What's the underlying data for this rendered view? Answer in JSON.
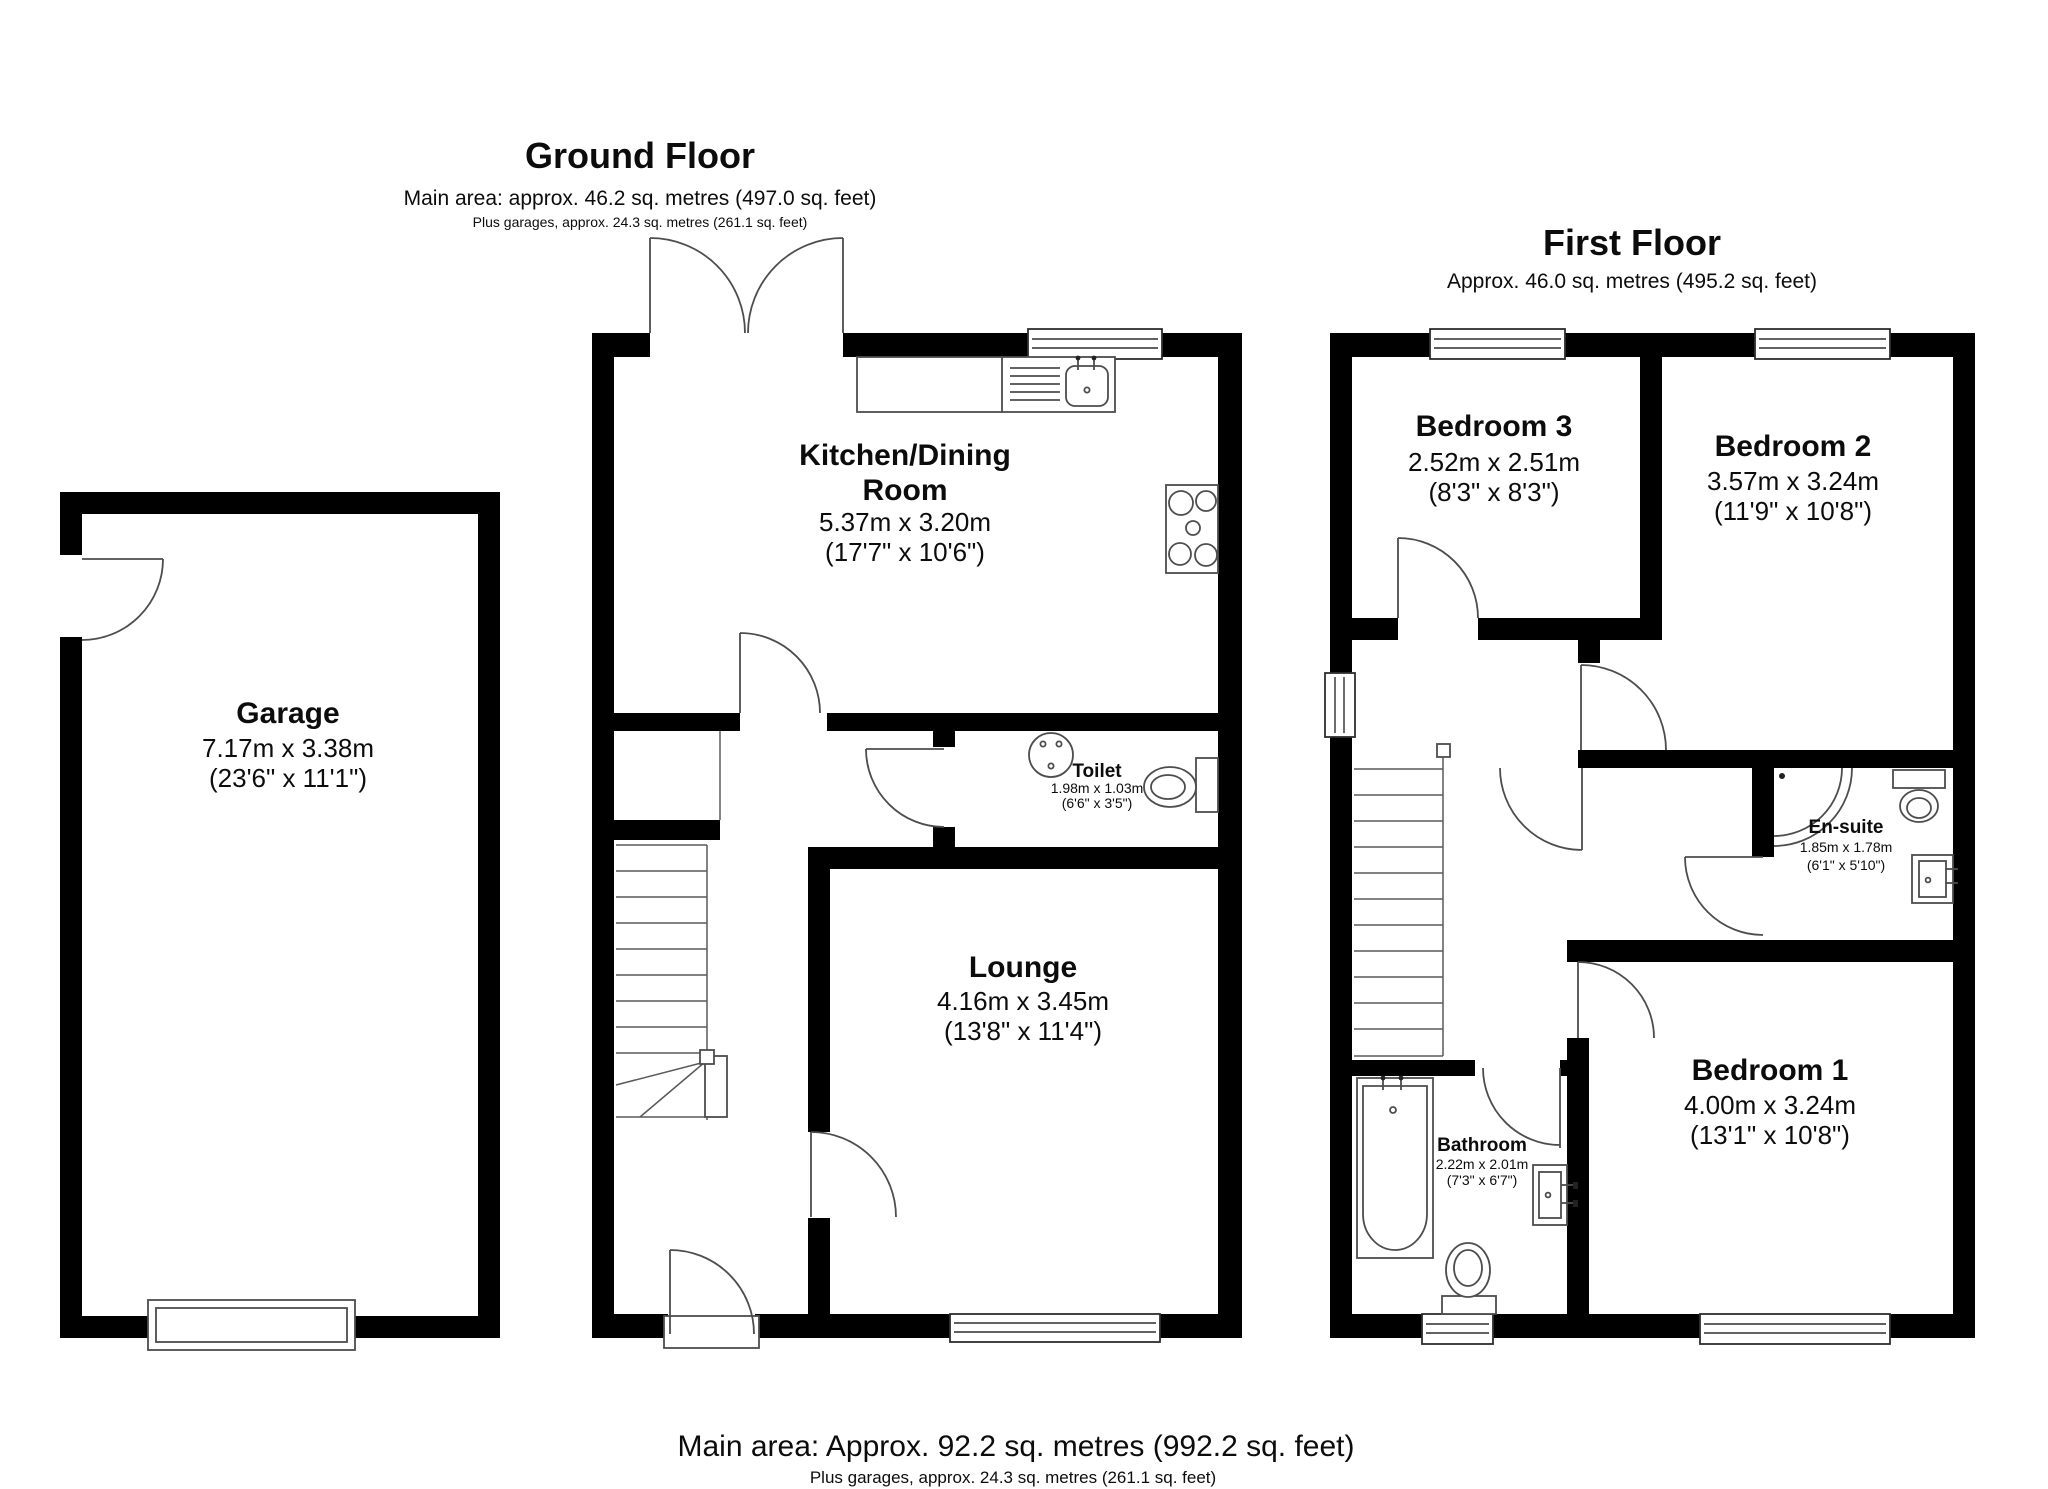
{
  "page": {
    "background": "#ffffff",
    "wall_color": "#000000",
    "fixture_color": "#4d4d4d"
  },
  "ground_floor": {
    "title": "Ground Floor",
    "area_line": "Main area: approx. 46.2 sq. metres (497.0 sq. feet)",
    "garage_line": "Plus garages, approx. 24.3 sq. metres (261.1 sq. feet)",
    "rooms": {
      "garage": {
        "name": "Garage",
        "metric": "7.17m x 3.38m",
        "imperial": "(23'6\" x 11'1\")"
      },
      "kitchen_dining": {
        "name_line1": "Kitchen/Dining",
        "name_line2": "Room",
        "metric": "5.37m x 3.20m",
        "imperial": "(17'7\" x 10'6\")"
      },
      "toilet": {
        "name": "Toilet",
        "metric": "1.98m x 1.03m",
        "imperial": "(6'6\" x 3'5\")"
      },
      "lounge": {
        "name": "Lounge",
        "metric": "4.16m x 3.45m",
        "imperial": "(13'8\" x 11'4\")"
      }
    }
  },
  "first_floor": {
    "title": "First Floor",
    "area_line": "Approx. 46.0 sq. metres (495.2 sq. feet)",
    "rooms": {
      "bedroom3": {
        "name": "Bedroom 3",
        "metric": "2.52m x 2.51m",
        "imperial": "(8'3\" x 8'3\")"
      },
      "bedroom2": {
        "name": "Bedroom 2",
        "metric": "3.57m x 3.24m",
        "imperial": "(11'9\" x 10'8\")"
      },
      "ensuite": {
        "name": "En-suite",
        "metric": "1.85m x 1.78m",
        "imperial": "(6'1\" x 5'10\")"
      },
      "bathroom": {
        "name": "Bathroom",
        "metric": "2.22m x 2.01m",
        "imperial": "(7'3\" x 6'7\")"
      },
      "bedroom1": {
        "name": "Bedroom 1",
        "metric": "4.00m x 3.24m",
        "imperial": "(13'1\" x 10'8\")"
      }
    }
  },
  "footer": {
    "main_area": "Main area: Approx. 92.2 sq. metres (992.2 sq. feet)",
    "garage_area": "Plus garages, approx. 24.3 sq. metres (261.1 sq. feet)"
  }
}
